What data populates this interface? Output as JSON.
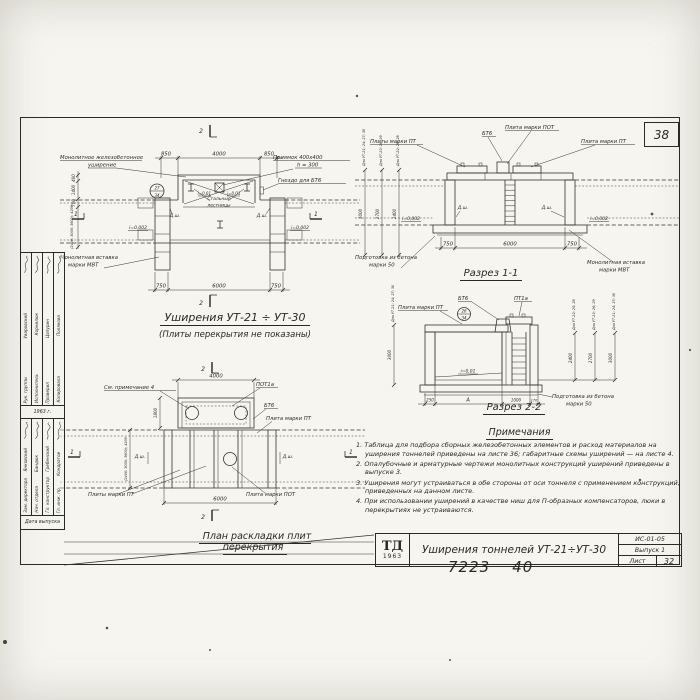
{
  "sheet": {
    "corner_number": "38",
    "handwritten_left": "7223",
    "handwritten_right": "40"
  },
  "plan_widening": {
    "title": "Уширения УТ-21 ÷ УТ-30",
    "subtitle": "(Плиты перекрытия не показаны)",
    "label_monolithic_1": "Монолитное железобетонное",
    "label_monolithic_2": "уширение",
    "label_pit_1": "Приямок 400х400",
    "label_pit_2": "h = 300",
    "label_socket": "Гнездо для БТ6",
    "label_ladders_1": "Стальные",
    "label_ladders_2": "лестницы",
    "label_insert_1": "Монолитная вставка",
    "label_insert_2": "марки МВТ",
    "joint": "Д.ш.",
    "slope_pit": "i=0,01",
    "slope_tunnel": "i=0,002",
    "detail_top": "27",
    "detail_bottom": "34",
    "dim_top_left": "850",
    "dim_top_mid": "4000",
    "dim_top_right": "850",
    "dim_bot_left": "750",
    "dim_bot_mid": "6000",
    "dim_bot_right": "750",
    "dim_left_1": "400",
    "dim_left_2": "1400",
    "dim_left_3": "700",
    "dim_left_span": "(2400; 3000; 3600); 4200",
    "mark_2": "2",
    "mark_1": "1"
  },
  "section11": {
    "title": "Разрез 1-1",
    "label_pt_left": "Плиты марки ПТ",
    "label_bt6": "БТ6",
    "label_pot": "Плита марки ПОТ",
    "label_pt_right": "Плита марки ПТ",
    "joint": "Д.ш.",
    "slope": "i=0,002",
    "label_prep_1": "Подготовка из бетона",
    "label_prep_2": "марки 50",
    "label_insert_1": "Монолитная вставка",
    "label_insert_2": "марки МВТ",
    "dim_bot_left": "750",
    "dim_bot_mid": "6000",
    "dim_bot_right": "750",
    "h1_label": "Для УТ-21; 24; 27; 30",
    "h1": "3000",
    "h2_label": "Для УТ-23; 26; 29",
    "h2": "2700",
    "h3_label": "Для УТ-22; 25; 28",
    "h3": "2400"
  },
  "plan_slabs": {
    "title": "План раскладки плит перекрытия",
    "label_note": "См. примечание 4",
    "label_pot1a": "ПОТ1а",
    "label_bt6": "БТ6",
    "label_pt": "Плита марки ПТ",
    "label_pts": "Плиты марки ПТ",
    "label_pot": "Плита марки ПОТ",
    "joint": "Д.ш.",
    "dim_top": "4000",
    "dim_bot": "6000",
    "dim_left_niche": "1800",
    "dim_left_span": "(2400; 3000; 3600); 4200",
    "mark_2": "2",
    "mark_1": "1"
  },
  "section22": {
    "title": "Разрез 2-2",
    "label_pt": "Плита марки ПТ",
    "label_bt6": "БТ6",
    "label_pt1a": "ПТ1а",
    "slope": "i=0,01",
    "label_prep_1": "Подготовка из бетона",
    "label_prep_2": "марки 50",
    "detail_top": "26",
    "detail_bottom": "34",
    "dim_1": "250",
    "dim_2": "А",
    "dim_3": "1000",
    "dim_4": "170",
    "hL_label": "Для УТ-21; 24; 27; 30",
    "hL": "3000",
    "h1_label": "Для УТ-22; 25; 28",
    "h1": "2400",
    "h2_label": "Для УТ-23; 26; 29",
    "h2": "2700",
    "h3_label": "Для УТ-21; 24; 27; 30",
    "h3": "3000"
  },
  "notes": {
    "title": "Примечания",
    "n1": "1. Таблица для подбора сборных железобетонных элементов и расход материалов на уширения тоннелей приведены на листе 36; габаритные схемы уширений — на листе 4.",
    "n2": "2. Опалубочные и арматурные чертежи монолитных конструкций уширений приведены в выпуске 3.",
    "n3": "3. Уширения могут устраиваться в обе стороны от оси тоннеля с применением конструкций, приведенных на данном листе.",
    "n4": "4. При использовании уширений в качестве ниш для П-образных компенсаторов, люки в перекрытиях не устраиваются."
  },
  "title_block": {
    "logo": "ТД",
    "logo_year": "1963",
    "title": "Уширения тоннелей УТ-21÷УТ-30",
    "code": "ИС-01-05",
    "issue": "Выпуск 1",
    "sheet_label": "Лист",
    "sheet_num": "32"
  },
  "stamp": {
    "year": "1963 г.",
    "date_label": "Дата выпуска",
    "g1": [
      {
        "role": "Рук. группы",
        "name": "Уваровский"
      },
      {
        "role": "Исполнитель",
        "name": "Корнилюк"
      },
      {
        "role": "Проверил",
        "name": "Цапурин"
      },
      {
        "role": "Копировала",
        "name": "Полякова"
      }
    ],
    "g2": [
      {
        "role": "Зам. директора",
        "name": "Янковский"
      },
      {
        "role": "Нач. отдела",
        "name": "Бандюк"
      },
      {
        "role": "Гл. конструктор",
        "name": "Гребенский"
      },
      {
        "role": "Гл. инж. пр.",
        "name": "Кондратов"
      }
    ]
  }
}
